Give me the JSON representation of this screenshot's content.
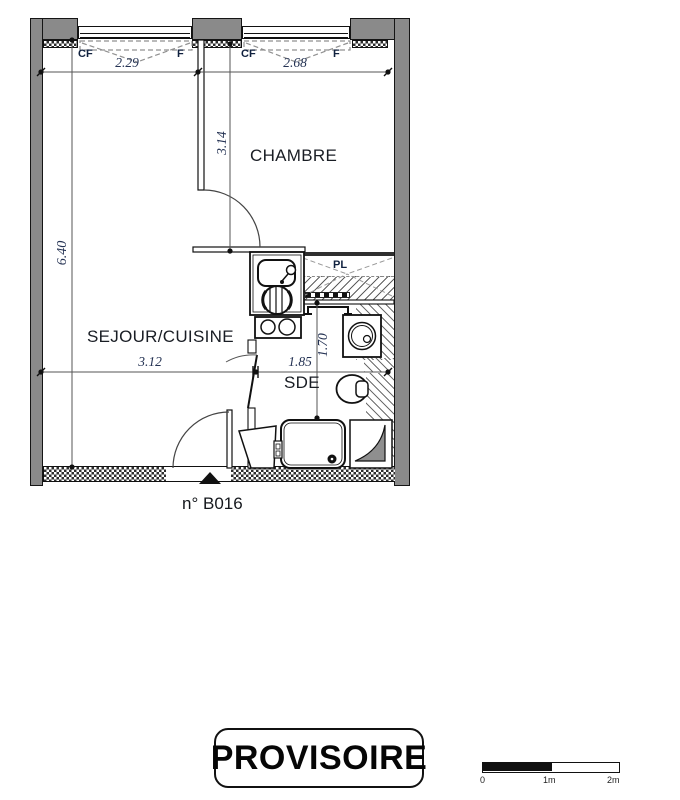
{
  "title_block": {
    "unit_number": "n° B016",
    "stamp": "PROVISOIRE"
  },
  "rooms": {
    "chambre": "CHAMBRE",
    "sejour_cuisine": "SEJOUR/CUISINE",
    "sde": "SDE",
    "placard": "PL"
  },
  "window_labels": {
    "w1_cf": "CF",
    "w1_f": "F",
    "w2_cf": "CF",
    "w2_f": "F"
  },
  "dimensions": {
    "window1_width": "2.29",
    "window2_width": "2.68",
    "chambre_depth": "3.14",
    "interior_height": "6.40",
    "sejour_width": "3.12",
    "sde_width": "1.85",
    "sde_depth": "1.70"
  },
  "scale_bar": {
    "zero": "0",
    "one": "1m",
    "two": "2m"
  },
  "colors": {
    "wall_fill": "#8a8a8a",
    "line": "#1a1a1a",
    "dim_text": "#243253",
    "label_text": "#191d24"
  }
}
